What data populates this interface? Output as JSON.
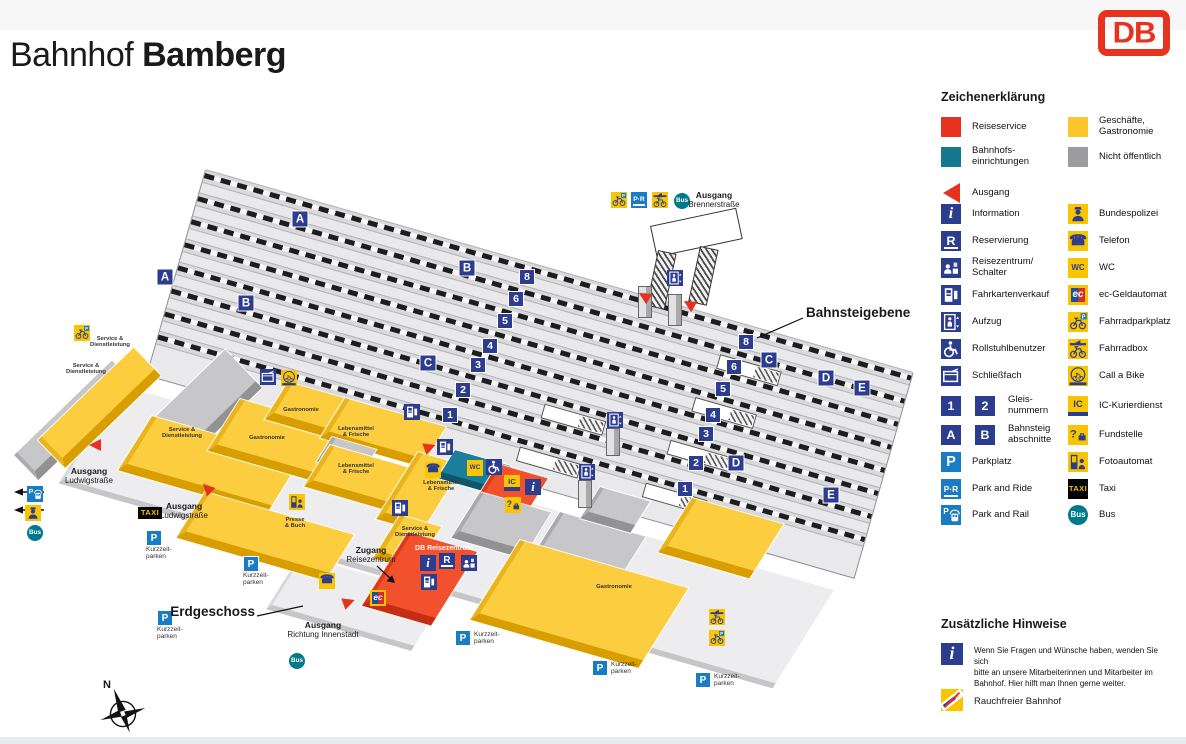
{
  "header": {
    "title_prefix": "Bahnhof",
    "title_name": "Bamberg",
    "logo": "DB"
  },
  "legend": {
    "title": "Zeichenerklärung",
    "items": [
      {
        "x": 941,
        "y": 117,
        "icon": "sq_red",
        "label": [
          "Reiseservice"
        ]
      },
      {
        "x": 1068,
        "y": 117,
        "icon": "sq_yellow",
        "label": [
          "Geschäfte,",
          "Gastronomie"
        ]
      },
      {
        "x": 941,
        "y": 147,
        "icon": "sq_teal",
        "label": [
          "Bahnhofs-",
          "einrichtungen"
        ]
      },
      {
        "x": 1068,
        "y": 147,
        "icon": "sq_gray",
        "label": [
          "Nicht öffentlich"
        ]
      },
      {
        "x": 941,
        "y": 183,
        "icon": "ausgang",
        "label": [
          "Ausgang"
        ]
      },
      {
        "x": 941,
        "y": 204,
        "icon": "info",
        "label": [
          "Information"
        ]
      },
      {
        "x": 1068,
        "y": 204,
        "icon": "polizei",
        "label": [
          "Bundespolizei"
        ]
      },
      {
        "x": 941,
        "y": 231,
        "icon": "reserv",
        "label": [
          "Reservierung"
        ]
      },
      {
        "x": 1068,
        "y": 231,
        "icon": "telefon",
        "label": [
          "Telefon"
        ]
      },
      {
        "x": 941,
        "y": 258,
        "icon": "schalter",
        "label": [
          "Reisezentrum/",
          "Schalter"
        ]
      },
      {
        "x": 1068,
        "y": 258,
        "icon": "wc",
        "label": [
          "WC"
        ]
      },
      {
        "x": 941,
        "y": 285,
        "icon": "ticket",
        "label": [
          "Fahrkartenverkauf"
        ]
      },
      {
        "x": 1068,
        "y": 285,
        "icon": "ec",
        "label": [
          "ec-Geldautomat"
        ]
      },
      {
        "x": 941,
        "y": 312,
        "icon": "aufzug",
        "label": [
          "Aufzug"
        ]
      },
      {
        "x": 1068,
        "y": 312,
        "icon": "bikeP",
        "label": [
          "Fahrradparkplatz"
        ]
      },
      {
        "x": 941,
        "y": 339,
        "icon": "rollstuhl",
        "label": [
          "Rollstuhlbenutzer"
        ]
      },
      {
        "x": 1068,
        "y": 339,
        "icon": "bikebox",
        "label": [
          "Fahrradbox"
        ]
      },
      {
        "x": 941,
        "y": 366,
        "icon": "fach",
        "label": [
          "Schließfach"
        ]
      },
      {
        "x": 1068,
        "y": 366,
        "icon": "callabike",
        "label": [
          "Call a Bike"
        ]
      },
      {
        "x": 941,
        "y": 396,
        "icon": "g1",
        "icon2": "g2",
        "lx": 1008,
        "label": [
          "Gleis-",
          "nummern"
        ]
      },
      {
        "x": 1068,
        "y": 396,
        "icon": "icd",
        "label": [
          "IC-Kurierdienst"
        ]
      },
      {
        "x": 941,
        "y": 425,
        "icon": "gA",
        "icon2": "gB",
        "lx": 1008,
        "label": [
          "Bahnsteig",
          "abschnitte"
        ]
      },
      {
        "x": 1068,
        "y": 425,
        "icon": "fund",
        "label": [
          "Fundstelle"
        ]
      },
      {
        "x": 941,
        "y": 452,
        "icon": "p",
        "label": [
          "Parkplatz"
        ]
      },
      {
        "x": 1068,
        "y": 452,
        "icon": "foto",
        "label": [
          "Fotoautomat"
        ]
      },
      {
        "x": 941,
        "y": 479,
        "icon": "pr",
        "label": [
          "Park and Ride"
        ]
      },
      {
        "x": 1068,
        "y": 479,
        "icon": "taxi",
        "label": [
          "Taxi"
        ]
      },
      {
        "x": 941,
        "y": 505,
        "icon": "prail",
        "label": [
          "Park and Rail"
        ]
      },
      {
        "x": 1068,
        "y": 505,
        "icon": "bus",
        "label": [
          "Bus"
        ]
      }
    ]
  },
  "notes": {
    "title": "Zusätzliche Hinweise",
    "info_text": [
      "Wenn Sie Fragen und Wünsche haben, wenden Sie sich",
      "bitte an unsere Mitarbeiterinnen und Mitarbeiter im",
      "Bahnhof. Hier hilft man Ihnen gerne weiter."
    ],
    "smoke_label": "Rauchfreier Bahnhof"
  },
  "map": {
    "compass": "N",
    "track_numbers": [
      {
        "v": "8",
        "x": 527,
        "y": 277
      },
      {
        "v": "8",
        "x": 746,
        "y": 342
      },
      {
        "v": "6",
        "x": 516,
        "y": 299
      },
      {
        "v": "6",
        "x": 734,
        "y": 367
      },
      {
        "v": "5",
        "x": 505,
        "y": 321
      },
      {
        "v": "5",
        "x": 723,
        "y": 389
      },
      {
        "v": "4",
        "x": 490,
        "y": 346
      },
      {
        "v": "4",
        "x": 713,
        "y": 415
      },
      {
        "v": "3",
        "x": 478,
        "y": 365
      },
      {
        "v": "3",
        "x": 706,
        "y": 434
      },
      {
        "v": "2",
        "x": 463,
        "y": 390
      },
      {
        "v": "2",
        "x": 696,
        "y": 463
      },
      {
        "v": "1",
        "x": 450,
        "y": 415
      },
      {
        "v": "1",
        "x": 685,
        "y": 489
      }
    ],
    "sections": [
      {
        "v": "A",
        "x": 300,
        "y": 219
      },
      {
        "v": "A",
        "x": 165,
        "y": 277
      },
      {
        "v": "B",
        "x": 467,
        "y": 268
      },
      {
        "v": "B",
        "x": 246,
        "y": 303
      },
      {
        "v": "C",
        "x": 769,
        "y": 360
      },
      {
        "v": "C",
        "x": 428,
        "y": 363
      },
      {
        "v": "D",
        "x": 826,
        "y": 378
      },
      {
        "v": "D",
        "x": 736,
        "y": 463
      },
      {
        "v": "E",
        "x": 862,
        "y": 388
      },
      {
        "v": "E",
        "x": 831,
        "y": 495
      }
    ],
    "icons": [
      {
        "t": "bikeP",
        "x": 619,
        "y": 200
      },
      {
        "t": "pr",
        "x": 639,
        "y": 200
      },
      {
        "t": "bikebox",
        "x": 660,
        "y": 200
      },
      {
        "t": "bus",
        "x": 682,
        "y": 201
      },
      {
        "t": "aufzug",
        "x": 675,
        "y": 278
      },
      {
        "t": "aufzug",
        "x": 615,
        "y": 420
      },
      {
        "t": "aufzug",
        "x": 587,
        "y": 472
      },
      {
        "t": "ticket",
        "x": 412,
        "y": 412
      },
      {
        "t": "ticket",
        "x": 445,
        "y": 447
      },
      {
        "t": "ticket",
        "x": 400,
        "y": 508
      },
      {
        "t": "ticket",
        "x": 429,
        "y": 582
      },
      {
        "t": "fach",
        "x": 268,
        "y": 377
      },
      {
        "t": "callabike",
        "x": 289,
        "y": 378
      },
      {
        "t": "bikeP",
        "x": 82,
        "y": 333
      },
      {
        "t": "wc",
        "x": 475,
        "y": 468
      },
      {
        "t": "rollstuhl",
        "x": 494,
        "y": 467
      },
      {
        "t": "telefon",
        "x": 433,
        "y": 470
      },
      {
        "t": "telefon",
        "x": 327,
        "y": 581
      },
      {
        "t": "icd",
        "x": 512,
        "y": 483
      },
      {
        "t": "info",
        "x": 533,
        "y": 487
      },
      {
        "t": "fund",
        "x": 513,
        "y": 505
      },
      {
        "t": "foto",
        "x": 297,
        "y": 502
      },
      {
        "t": "ec",
        "x": 378,
        "y": 598
      },
      {
        "t": "info",
        "x": 428,
        "y": 563
      },
      {
        "t": "reserv",
        "x": 447,
        "y": 561
      },
      {
        "t": "schalter",
        "x": 469,
        "y": 563
      },
      {
        "t": "prail",
        "x": 35,
        "y": 494
      },
      {
        "t": "polizei",
        "x": 33,
        "y": 513
      },
      {
        "t": "bus",
        "x": 35,
        "y": 533
      },
      {
        "t": "taxi",
        "x": 150,
        "y": 513
      },
      {
        "t": "bus",
        "x": 297,
        "y": 661
      },
      {
        "t": "bikebox",
        "x": 717,
        "y": 617
      },
      {
        "t": "bikeP",
        "x": 717,
        "y": 638
      }
    ],
    "parking": [
      {
        "x": 146,
        "y": 530,
        "pos": "below",
        "lines": [
          "Kurzzeit-",
          "parken"
        ]
      },
      {
        "x": 243,
        "y": 556,
        "pos": "below",
        "lines": [
          "Kurzzeit-",
          "parken"
        ]
      },
      {
        "x": 157,
        "y": 610,
        "pos": "below",
        "lines": [
          "Kurzzeit-",
          "parken"
        ]
      },
      {
        "x": 455,
        "y": 630,
        "pos": "right",
        "lines": [
          "Kurzzeit-",
          "parken"
        ]
      },
      {
        "x": 592,
        "y": 660,
        "pos": "right",
        "lines": [
          "Kurzzeit-",
          "parken"
        ]
      },
      {
        "x": 695,
        "y": 672,
        "pos": "right",
        "lines": [
          "Kurzzeit-",
          "parken"
        ]
      }
    ],
    "texts": [
      {
        "x": 714,
        "y": 191,
        "a": "center",
        "s": "exit",
        "lines": [
          "Ausgang",
          "Brennerstraße"
        ]
      },
      {
        "x": 806,
        "y": 305,
        "a": "left",
        "s": "big",
        "lines": [
          "Bahnsteigebene"
        ]
      },
      {
        "x": 255,
        "y": 604,
        "a": "right",
        "s": "big",
        "lines": [
          "Erdgeschoss"
        ]
      },
      {
        "x": 89,
        "y": 467,
        "a": "center",
        "s": "exit",
        "lines": [
          "Ausgang",
          "Ludwigstraße"
        ]
      },
      {
        "x": 184,
        "y": 502,
        "a": "center",
        "s": "exit",
        "lines": [
          "Ausgang",
          "Ludwigstraße"
        ]
      },
      {
        "x": 323,
        "y": 621,
        "a": "center",
        "s": "exit",
        "lines": [
          "Ausgang",
          "Richtung Innenstadt"
        ]
      },
      {
        "x": 371,
        "y": 546,
        "a": "center",
        "s": "exit",
        "lines": [
          "Zugang",
          "Reisezentrum"
        ]
      }
    ],
    "buildings": [
      {
        "x": 14,
        "y": 455,
        "w": 132,
        "h": 26,
        "c": "gray",
        "t": "w"
      },
      {
        "x": 38,
        "y": 440,
        "w": 128,
        "h": 30,
        "c": "yellow",
        "t": "w"
      },
      {
        "x": 146,
        "y": 426,
        "w": 106,
        "h": 44,
        "c": "gray",
        "t": "w"
      },
      {
        "x": 152,
        "y": 416,
        "w": 150,
        "h": 55,
        "c": "yellow"
      },
      {
        "x": 240,
        "y": 399,
        "w": 110,
        "h": 52,
        "c": "yellow"
      },
      {
        "x": 288,
        "y": 382,
        "w": 95,
        "h": 35,
        "c": "yellow"
      },
      {
        "x": 345,
        "y": 398,
        "w": 100,
        "h": 38,
        "c": "yellow"
      },
      {
        "x": 332,
        "y": 437,
        "w": 42,
        "h": 20,
        "c": "gray"
      },
      {
        "x": 330,
        "y": 445,
        "w": 100,
        "h": 40,
        "c": "yellow"
      },
      {
        "x": 205,
        "y": 492,
        "w": 150,
        "h": 45,
        "c": "yellow"
      },
      {
        "x": 418,
        "y": 452,
        "w": 42,
        "h": 70,
        "c": "yellow"
      },
      {
        "x": 400,
        "y": 515,
        "w": 38,
        "h": 42,
        "c": "yellow"
      },
      {
        "x": 455,
        "y": 450,
        "w": 58,
        "h": 26,
        "c": "teal"
      },
      {
        "x": 498,
        "y": 464,
        "w": 48,
        "h": 58,
        "c": "red"
      },
      {
        "x": 408,
        "y": 532,
        "w": 68,
        "h": 78,
        "c": "red"
      },
      {
        "x": 480,
        "y": 492,
        "w": 70,
        "h": 45,
        "c": "gray"
      },
      {
        "x": 560,
        "y": 512,
        "w": 85,
        "h": 50,
        "c": "gray"
      },
      {
        "x": 600,
        "y": 487,
        "w": 48,
        "h": 28,
        "c": "gray"
      },
      {
        "x": 520,
        "y": 540,
        "w": 170,
        "h": 85,
        "c": "yellow"
      },
      {
        "x": 692,
        "y": 498,
        "w": 90,
        "h": 55,
        "c": "yellow"
      }
    ],
    "building_labels": [
      {
        "x": 110,
        "y": 336,
        "lines": [
          "Service &",
          "Dienstleistung"
        ]
      },
      {
        "x": 86,
        "y": 363,
        "lines": [
          "Service &",
          "Dienstleistung"
        ]
      },
      {
        "x": 182,
        "y": 427,
        "lines": [
          "Service &",
          "Dienstleistung"
        ]
      },
      {
        "x": 267,
        "y": 435,
        "lines": [
          "Gastronomie"
        ]
      },
      {
        "x": 301,
        "y": 407,
        "lines": [
          "Gastronomie"
        ]
      },
      {
        "x": 356,
        "y": 426,
        "lines": [
          "Lebensmittel",
          "& Frische"
        ]
      },
      {
        "x": 356,
        "y": 463,
        "lines": [
          "Lebensmittel",
          "& Frische"
        ]
      },
      {
        "x": 441,
        "y": 480,
        "lines": [
          "Lebensmittel",
          "& Frische"
        ]
      },
      {
        "x": 295,
        "y": 517,
        "lines": [
          "Presse",
          "& Buch"
        ]
      },
      {
        "x": 415,
        "y": 526,
        "lines": [
          "Service &",
          "Dienstleistung"
        ]
      },
      {
        "x": 444,
        "y": 545,
        "cls": "rz",
        "lines": [
          "DB Reisezentrum"
        ]
      },
      {
        "x": 614,
        "y": 584,
        "lines": [
          "Gastronomie"
        ]
      }
    ],
    "arrows": [
      {
        "x": 95,
        "y": 445,
        "r": 0
      },
      {
        "x": 430,
        "y": 447,
        "r": 160
      },
      {
        "x": 207,
        "y": 488,
        "r": 45
      },
      {
        "x": 349,
        "y": 602,
        "r": 160
      },
      {
        "x": 644,
        "y": 296,
        "r": 30
      },
      {
        "x": 689,
        "y": 304,
        "r": 30
      }
    ]
  }
}
